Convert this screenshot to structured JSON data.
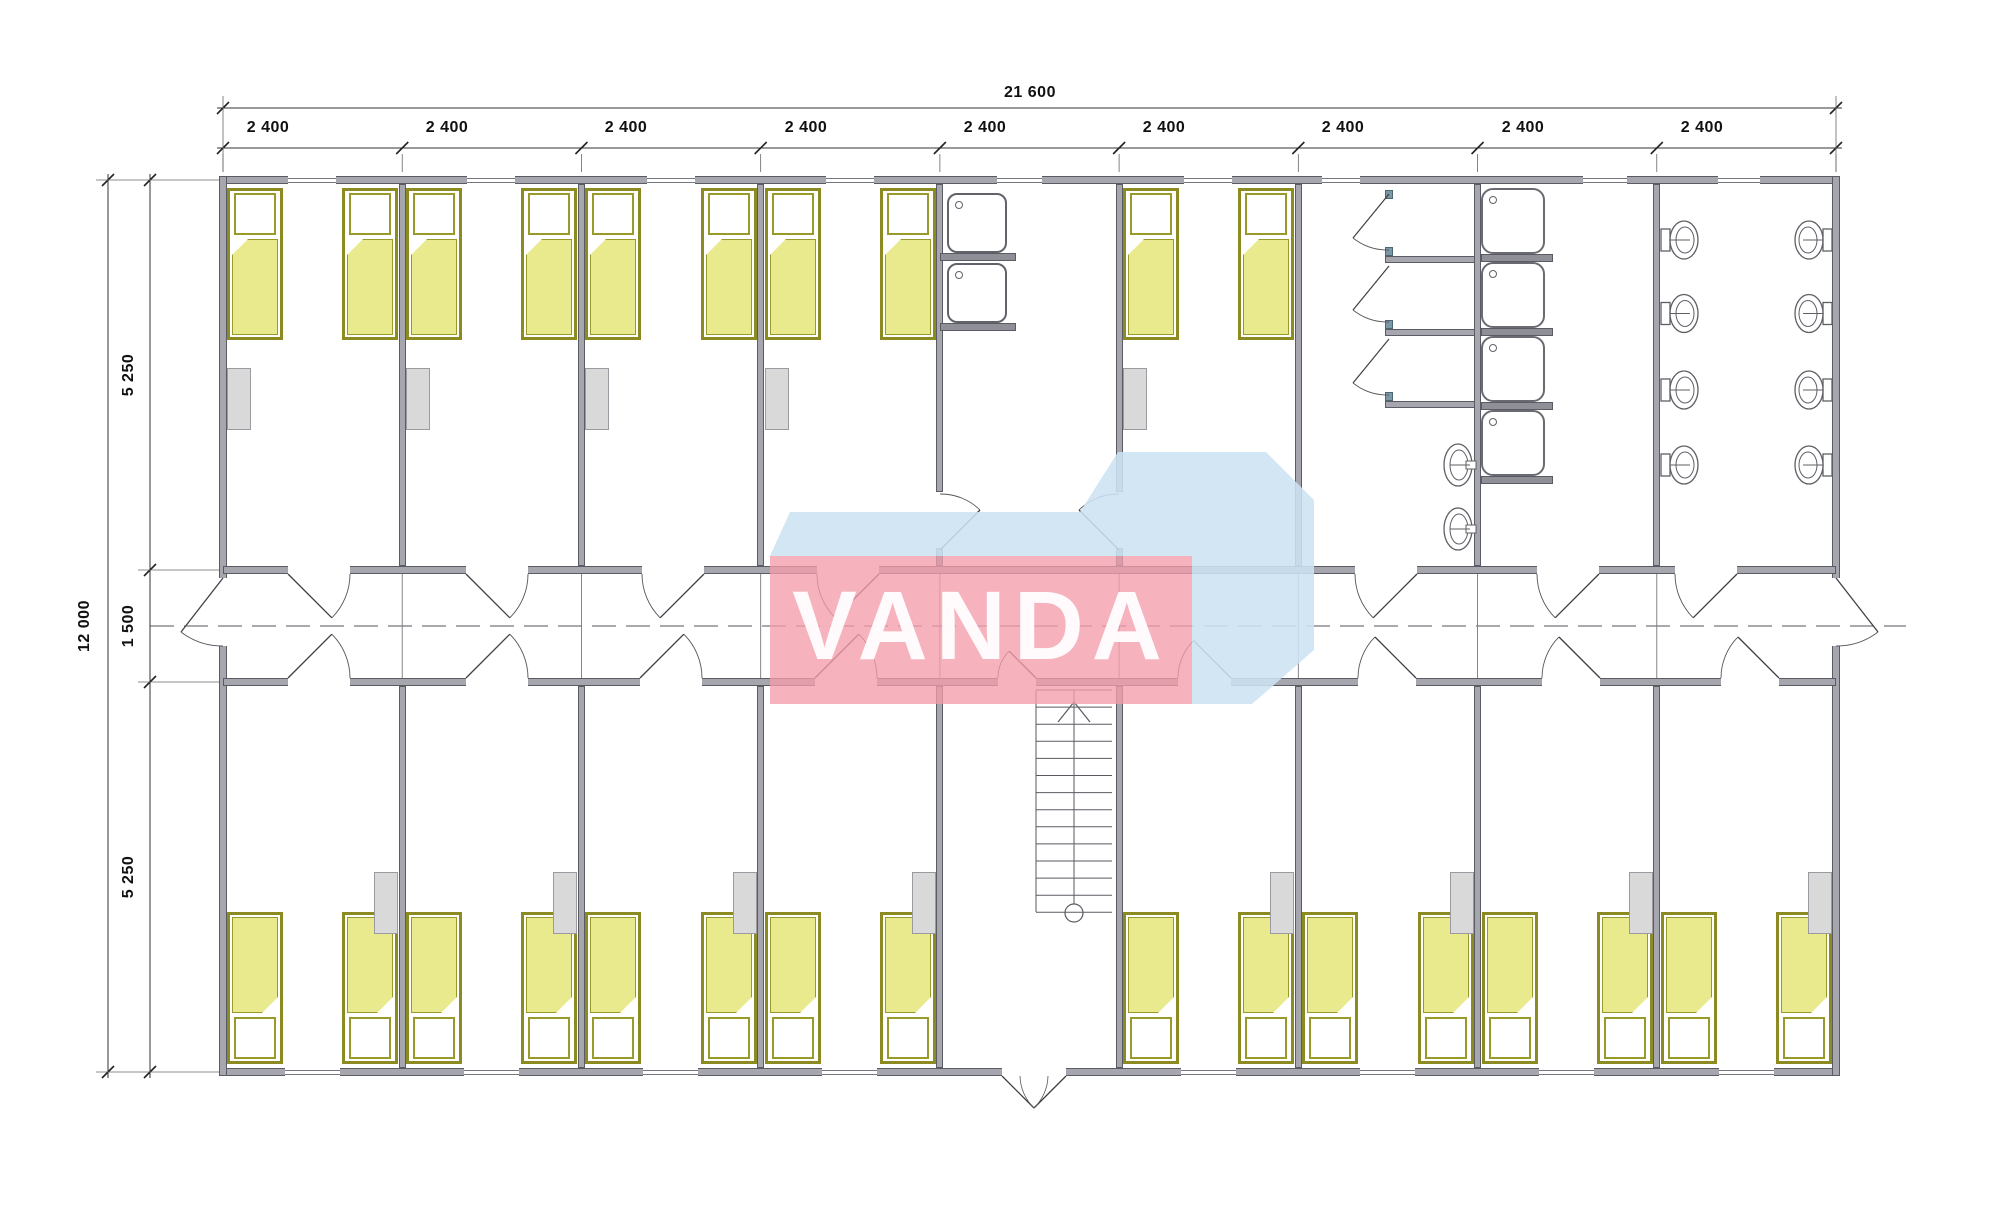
{
  "watermark": {
    "text": "VANDA",
    "pink": "#f49eaa",
    "blue": "#cde3f2"
  },
  "dimensions": {
    "top_total": "21 600",
    "top_segments": [
      "2 400",
      "2 400",
      "2 400",
      "2 400",
      "2 400",
      "2 400",
      "2 400",
      "2 400",
      "2 400"
    ],
    "side_total": "12 000",
    "side_segments": [
      "5 250",
      "1 500",
      "5 250"
    ]
  },
  "fixtures": {
    "beds": 26,
    "bedside_cabinets": 13,
    "washroom_sinks": 2,
    "shower_cubicles": 3,
    "shower_trays": 4,
    "wash_basins": 2,
    "toilets": 8,
    "staircases": 1,
    "entrance_doors": 1
  },
  "colors": {
    "wall": "#a6a6af",
    "bed_fill": "#e9e98e",
    "bed_frame": "#8b8b21",
    "cabinet": "#d9d9d9"
  }
}
